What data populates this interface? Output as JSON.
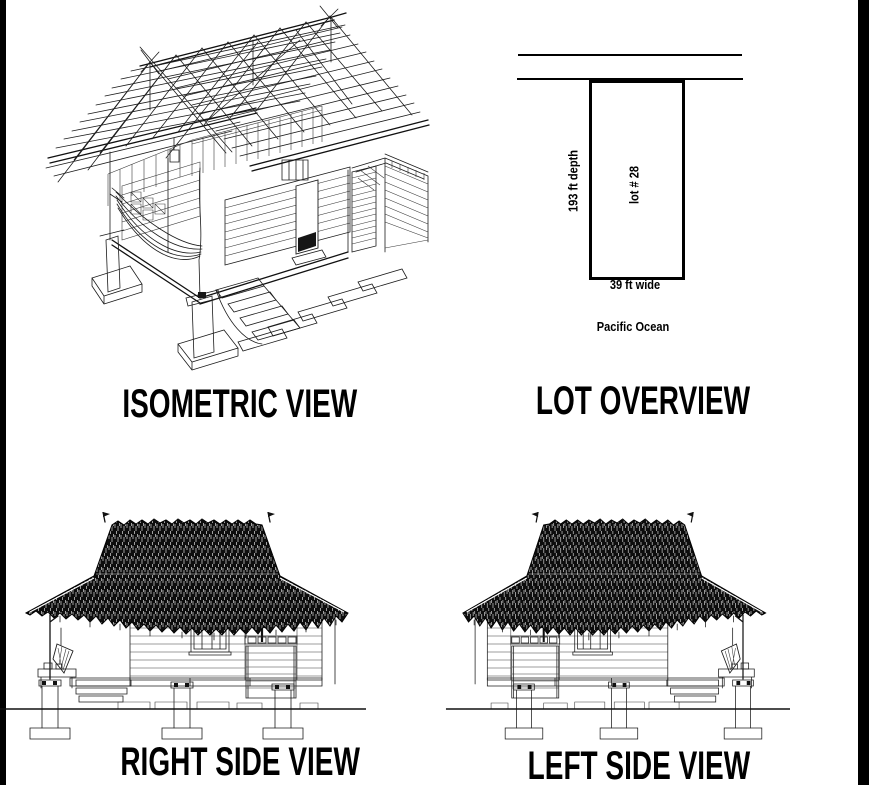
{
  "sheet": {
    "paper_color": "#ffffff",
    "ink_color": "#000000",
    "edge_bar_color": "#000000"
  },
  "panels": {
    "isometric": {
      "title": "ISOMETRIC VIEW"
    },
    "lot": {
      "title": "LOT OVERVIEW",
      "depth_label": "193 ft depth",
      "lot_number_label": "lot # 28",
      "width_label": "39 ft wide",
      "ocean_label": "Pacific Ocean"
    },
    "right_side": {
      "title": "RIGHT SIDE VIEW"
    },
    "left_side": {
      "title": "LEFT SIDE VIEW"
    }
  }
}
